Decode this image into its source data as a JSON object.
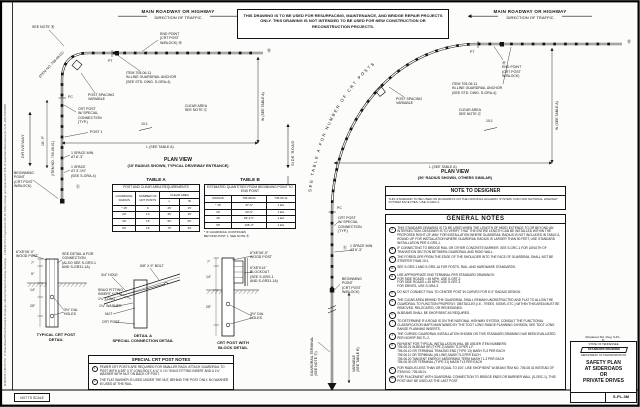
{
  "margin": {
    "file_info": "8/18/2023 2:48:25 PM   P:\\StandDrawOfficial\\Standards Drawings Library\\Standard Roadway Drawings - CURRENT\\In Progress\\10-106-00 Safety Design and Quantities\\P-106-10 Guardrail Maintenance (P+S-PL-3M) 20230808",
    "not_to_scale": "NOT TO SCALE"
  },
  "notice": "THIS DRAWING IS TO BE USED FOR RESURFACING, MAINTENANCE, AND BRIDGE REPAIR PROJECTS ONLY. THIS DRAWING IS NOT INTENDED TO BE USED FOR NEW CONSTRUCTION OR RECONSTRUCTION PROJECTS.",
  "plan_left": {
    "roadway_line1": "MAIN ROADWAY OR HIGHWAY",
    "roadway_line2": "DIRECTION OF TRAFFIC",
    "see_note": "SEE NOTE Ⓑ",
    "item_rail": "(ITEM NO. 705-08.01)",
    "end_point": "END POINT\n(CRT POST\nW/BLOCK) Ⓜ",
    "anchor": "ITEM 705-06.11\nIN-LINE GUARDRAIL ANCHOR\n(SEE STD. DWG. S-GRA-4)",
    "post_spacing": "POST SPACING\nVARIABLE",
    "pt": "PT",
    "pc": "PC",
    "crt_special": "CRT POST\nW/ SPECIAL\nCONNECTION\n(TYP.)",
    "post1": "POST 1",
    "clear_area": "CLEAR AREA\nSEE NOTE Ⓖ",
    "slope": "10:1",
    "dim_l": "L (SEE TABLE A)",
    "dim_w": "W (SEE TABLE A)",
    "driveway": "DRIVEWAY",
    "dim_18_9": "18'- 9\"",
    "item_rail_vert": "(ITEM NO. 705-08.01)",
    "space_min": "1 SPACE MIN.\nAT 6'-3\"",
    "space_1": "1 SPACE\nAT 3'-1½\"\n(SEE S-GRA-4)",
    "ref_e": "Ⓔ",
    "beginning_point": "BEGINNING\nPOINT\n(CRT POST\nW/BLOCK)",
    "end_ref": "Ⓑ",
    "title": "PLAN VIEW",
    "subtitle": "(15' RADIUS SHOWN, TYPICAL DRIVEWAY ENTRANCE)"
  },
  "plan_right": {
    "roadway_line1": "MAIN ROADWAY OR HIGHWAY",
    "roadway_line2": "DIRECTION OF TRAFFIC",
    "arc_text": "SEE TABLE A FOR NUMBER OF CRT POSTS",
    "end_point": "Ⓜ\nEND POINT\n(CRT POST\nW/BLOCK)",
    "anchor": "ITEM 705-06.11\nIN-LINE GUARDRAIL ANCHOR\n(SEE STD. DWG. S-GRA-4)",
    "post_spacing": "POST SPACING\nVARIABLE",
    "side_road": "SIDE ROAD",
    "crt_special": "CRT POST\nW/ SPECIAL\nCONNECTION\n(TYP.)",
    "pc": "PC",
    "pt": "PT",
    "ref_e": "Ⓔ",
    "space_min": "1 SPACE MIN.\nAT 6'-3\"",
    "clear_area": "CLEAR AREA\nSEE NOTE Ⓖ",
    "slope": "10:1",
    "dim_l": "L (SEE TABLE A)",
    "dim_w": "W (SEE TABLE A)",
    "beginning_point": "BEGINNING\nPOINT\n(CRT POST\nW/BLOCK)",
    "variable_dim": "VARIABLE\n(SEE TABLE B)",
    "terminal": "GUARDRAIL TERMINAL\n(SEE NOTE Ⓔ)",
    "end_ref": "Ⓑ",
    "title": "PLAN VIEW",
    "subtitle": "(50' RADIUS SHOWN, OTHERS SIMILAR)"
  },
  "table_a": {
    "title": "TABLE A",
    "header": "POST AND CLEAR AREA REQUIREMENTS",
    "col_radius": "GUARDRAIL RADIUS",
    "col_posts": "NUMBER OF CRT POSTS",
    "col_clear": "CLEAR AREA",
    "col_l": "L",
    "col_w": "W",
    "rows": [
      [
        "* 15'",
        "9",
        "25'",
        "15'"
      ],
      [
        "20'",
        "10",
        "25'",
        "15'"
      ],
      [
        "40'",
        "15",
        "50'",
        "20'"
      ],
      [
        "50'",
        "18",
        "75'",
        "30'"
      ]
    ]
  },
  "table_b": {
    "title": "TABLE B",
    "header": "ESTIMATED QUANTITIES FROM BEGINNING POINT TO END POINT",
    "col_radius": "RADIUS",
    "col_a": "705-08.01",
    "col_b": "705-06.11",
    "rows": [
      [
        "* 15'",
        "37'-6\"",
        "1 EA"
      ],
      [
        "20'",
        "43'-9\"",
        "1 EA"
      ],
      [
        "40'",
        "93'-1½\"",
        "1 EA"
      ],
      [
        "50'",
        "106'-3\"",
        "1 EA"
      ]
    ],
    "footnote": "* IF GUARDRAIL CONTINUES\n  BEYOND POST 1, SEE NOTE Ⓔ"
  },
  "note_to_designer": {
    "title": "NOTE TO DESIGNER",
    "text": "THIS STANDARD TO BE USED ON ROADWAYS ON THE NATIONAL HIGHWAY SYSTEM. FOR NON NATIONAL HIGHWAY SYSTEM FACILITIES, USE S-GRA-4."
  },
  "general_notes": {
    "title": "GENERAL NOTES",
    "notes": [
      {
        "letter": "A",
        "text": "THIS STANDARD DRAWING IS TO BE USED WHEN THE LENGTH OF NEED EXTENDS TO OR BEYOND AN INTERSECTION. DESIGNER IS TO VERIFY THAT THE ENTIRE LENGTH CAN BE INSTALLED WITHIN THE PROPOSED RIGHT-OF-WAY. FOR INSTALLATION WHERE GUARDRAIL RADIUS IS NOT INCLUDED IN TABLE A, ROUND UP. FOR INSTALLATION WHERE GUARDRAIL RADIUS IS LARGER THAN 50 FEET, USE STANDARD INSTALLATION PER S-GRS-1."
      },
      {
        "letter": "B",
        "text": "IF CONNECTING TO BRIDGE RAIL OR OTHER CONCRETE BARRIER, SEE S-GRC-1 FOR LENGTH OF TRANSITION SECTION BETWEEN GUARDRAIL AND RIGID WALL."
      },
      {
        "letter": "C",
        "text": "THE FORESLOPE FROM THE EDGE OF THE SHOULDER INTO THE FACE OF GUARDRAIL SHALL NOT BE STEEPER THAN 10:1."
      },
      {
        "letter": "D",
        "text": "SEE S-GRS-1 AND S-GRS-1A FOR POSTS, RAIL, AND HARDWARE STANDARDS."
      },
      {
        "letter": "E",
        "text": "USE APPROPRIATE END TERMINAL PER STANDARD DRAWINGS:\nFOR SIDE ROADS > 45 MPH, USE S-GRT-2\nFOR SIDE ROADS ≤ 45 MPH, USE S-GRT-3\nFOR DRIVES, USE S-GRA-3"
      },
      {
        "letter": "F",
        "text": "DO NOT CONNECT RAIL TO CENTER POST IN CURVES FOR 8'-0\" RADIUS DESIGN."
      },
      {
        "letter": "G",
        "text": "THE CLEAR AREA BEHIND THE GUARDRAIL SHALL REMAIN UNOBSTRUCTED AND FLAT TO ALLOW THE GUARDRAIL TO FUNCTION PROPERLY. OBSTACLES (I.E., TREES, SIGNS, ETC.) WITHIN THIS AREA MUST BE REMOVED, RELOCATED, OR REDESIGNED."
      },
      {
        "letter": "H",
        "text": "W-BEAMS SHALL BE SHOP BENT AS REQUIRED."
      },
      {
        "letter": "I",
        "text": "TO DETERMINE IF A ROAD IS ON THE NATIONAL HIGHWAY SYSTEM, CONSULT THE FUNCTIONAL CLASSIFICATION MAPS MAINTAINED BY THE TDOT LONG RANGE PLANNING DIVISION, SEE TDOT LONG RANGE PLANNING INSERTS."
      },
      {
        "letter": "J",
        "text": "THE CURVED GUARDRAIL INSTALLATION SHOWN ON THIS STANDARD DRAWING HAS BEEN EVALUATED PER NCHRP 350 TL-2."
      },
      {
        "letter": "K",
        "text": "PAYMENT FOR TYPICAL INSTALLATION WILL BE UNDER ITEM NUMBERS:\n705-08.01  W-BEAM GR (TYPE 2) MASH TL3 PER L.F.\n705-06.10  GR TERMINAL TRAILING END (TYPE 13) MASH TL3 PER EACH\n705-06.11  GR TERMINAL (IN-LINE) MASH TL3 PER EACH\n705-06.20  TANGENT ENERGY ABSORBING TERM MASH TL-3 PER EACH\n705-06.30  GR TERMINAL (TYPE 21) MASH TL3 PER EACH"
      },
      {
        "letter": "L",
        "text": "FOR RADIUS LESS THAN OR EQUAL TO 100', USE SHOP BENT W-BEAM ITEM NO. 705-08.02 INSTEAD OF ITEM NO. 705-08.01."
      },
      {
        "letter": "M",
        "text": "FOR PLACEMENT WITH GUARDRAIL CONNECTION TO BRIDGE ENDS OR BARRIER WALL (S-GRC-1), THIS POST MAY BE USED AS THE LAST POST."
      }
    ]
  },
  "details": {
    "typical": {
      "title": "TYPICAL CRT POST\nDETAIL",
      "wood_post": "6\"X8\"X6'-0\"\nWOOD POST",
      "see_detail": "SEE DETAIL A FOR\nCONNECTION\n(ALSO SEE S-GRS-1\nAND S-GR31-1A)",
      "holes": "3½\" DIA.\nHOLES",
      "dims": [
        "7\"",
        "9\"",
        "14\"",
        "25\""
      ]
    },
    "detail_a": {
      "title": "DETAIL A\nSPECIAL CONNECTION DETAIL",
      "bolt": "5/8\" X 9\" BOLT",
      "hole": "3/4\" HOLE",
      "insert": "SNUG FITTING\nINSERT ¾\" I.D.,\n1¾\" LONG",
      "washer": "1¾\" WASHER",
      "nut": "NUT",
      "crt_post": "CRT POST"
    },
    "block": {
      "title": "CRT POST WITH\nBLOCK DETAIL",
      "wood_post": "6\"X8\"X6'-0\"\nWOOD POST",
      "blockout": "6\"X8\"X14\"\nBLOCKOUT\n(SEE S-GRS-1\nAND S-GR31-1A)",
      "holes": "3½\" DIA.\nHOLES",
      "dims": [
        "7\"",
        "14\"",
        "25\""
      ]
    }
  },
  "special_notes": {
    "title": "SPECIAL CRT POST NOTES",
    "items": [
      {
        "num": "1",
        "text": "FEWER CRT POSTS ARE REQUIRED FOR SMALLER RADII. ATTACH GUARDRAIL TO POST WITH A 5/8\" X 9\" LONG BOLT, A ¾\" X 1¾\" SNUG FITTING INSERT AND A 1¾\" WASHER WITH NUT ON BACK OF POST."
      },
      {
        "num": "2",
        "text": "THE FLAT WASHER IS USED UNDER THE NUT, BEHIND THE POST ONLY. NO WASHER IS USED AT THE RAIL."
      }
    ]
  },
  "title_block": {
    "replaced": "(Replaced Std. Dwg. S-PL-3)",
    "state": "STATE OF TENNESSEE",
    "banner": "STANDARD DRAWING",
    "department": "DEPARTMENT OF TRANSPORTATION",
    "title_lines": [
      "SAFETY PLAN",
      "AT SIDEROADS",
      "OR",
      "PRIVATE DRIVES"
    ],
    "number": "S-PL-3M"
  },
  "colors": {
    "line": "#141414",
    "paper": "#fcfcfa"
  }
}
